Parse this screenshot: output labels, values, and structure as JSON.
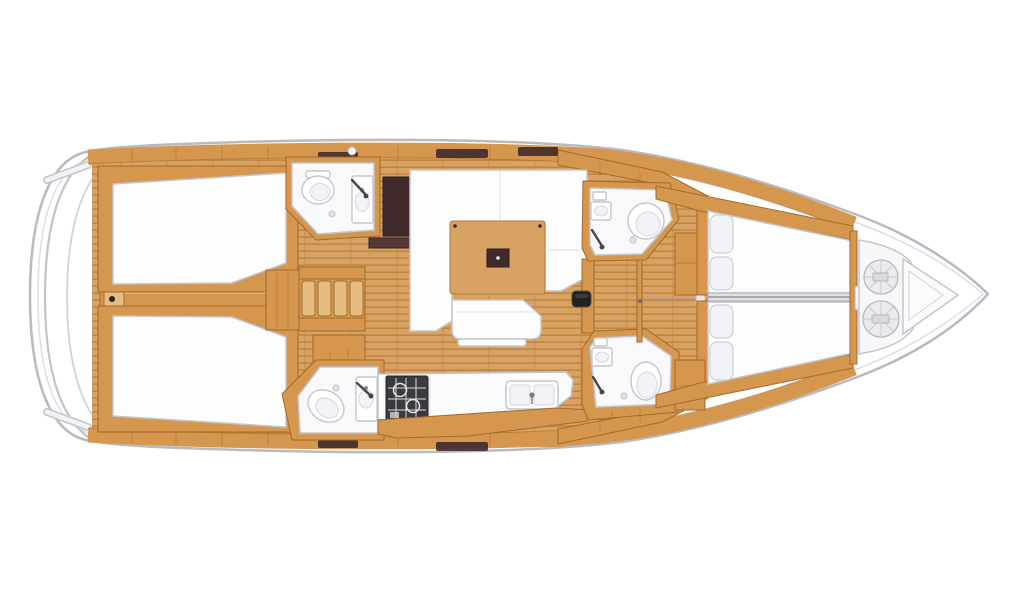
{
  "diagram": {
    "type": "yacht-interior-floor-plan",
    "orientation": "bow-right"
  },
  "inventory": {
    "cabin_count": 4,
    "head_count": 4,
    "zones": [
      "aft-cabin-port",
      "aft-cabin-starboard",
      "aft-head-port",
      "aft-head-starboard",
      "companionway-stairs",
      "engine-box",
      "saloon-settee",
      "saloon-table",
      "saloon-bench",
      "nav-seat",
      "galley",
      "stove",
      "galley-sink",
      "fore-head-port",
      "fore-head-starboard",
      "fore-cabin-port",
      "fore-cabin-starboard",
      "anchor-locker",
      "bow-pulpit"
    ]
  },
  "colors": {
    "hull_stroke": "#b7bac2",
    "deck_line": "#dcdee3",
    "wood": "#d5974e",
    "wood_edge": "#a26a2b",
    "wood_light": "#e7bc82",
    "floor": "#d8a262",
    "floor_stripe": "#c18544",
    "room_white": "#f9f9fb",
    "fixture_stroke": "#c3c6ce",
    "dark_brown": "#402a2c",
    "dark_brown2": "#55393a",
    "stove": "#3a3b3e",
    "stove_line": "#dcdcde",
    "bed": "#fdfdfe",
    "pillow": "#f2f3f6",
    "coil": "#ebebef",
    "coil_edge": "#b6b7bf"
  }
}
